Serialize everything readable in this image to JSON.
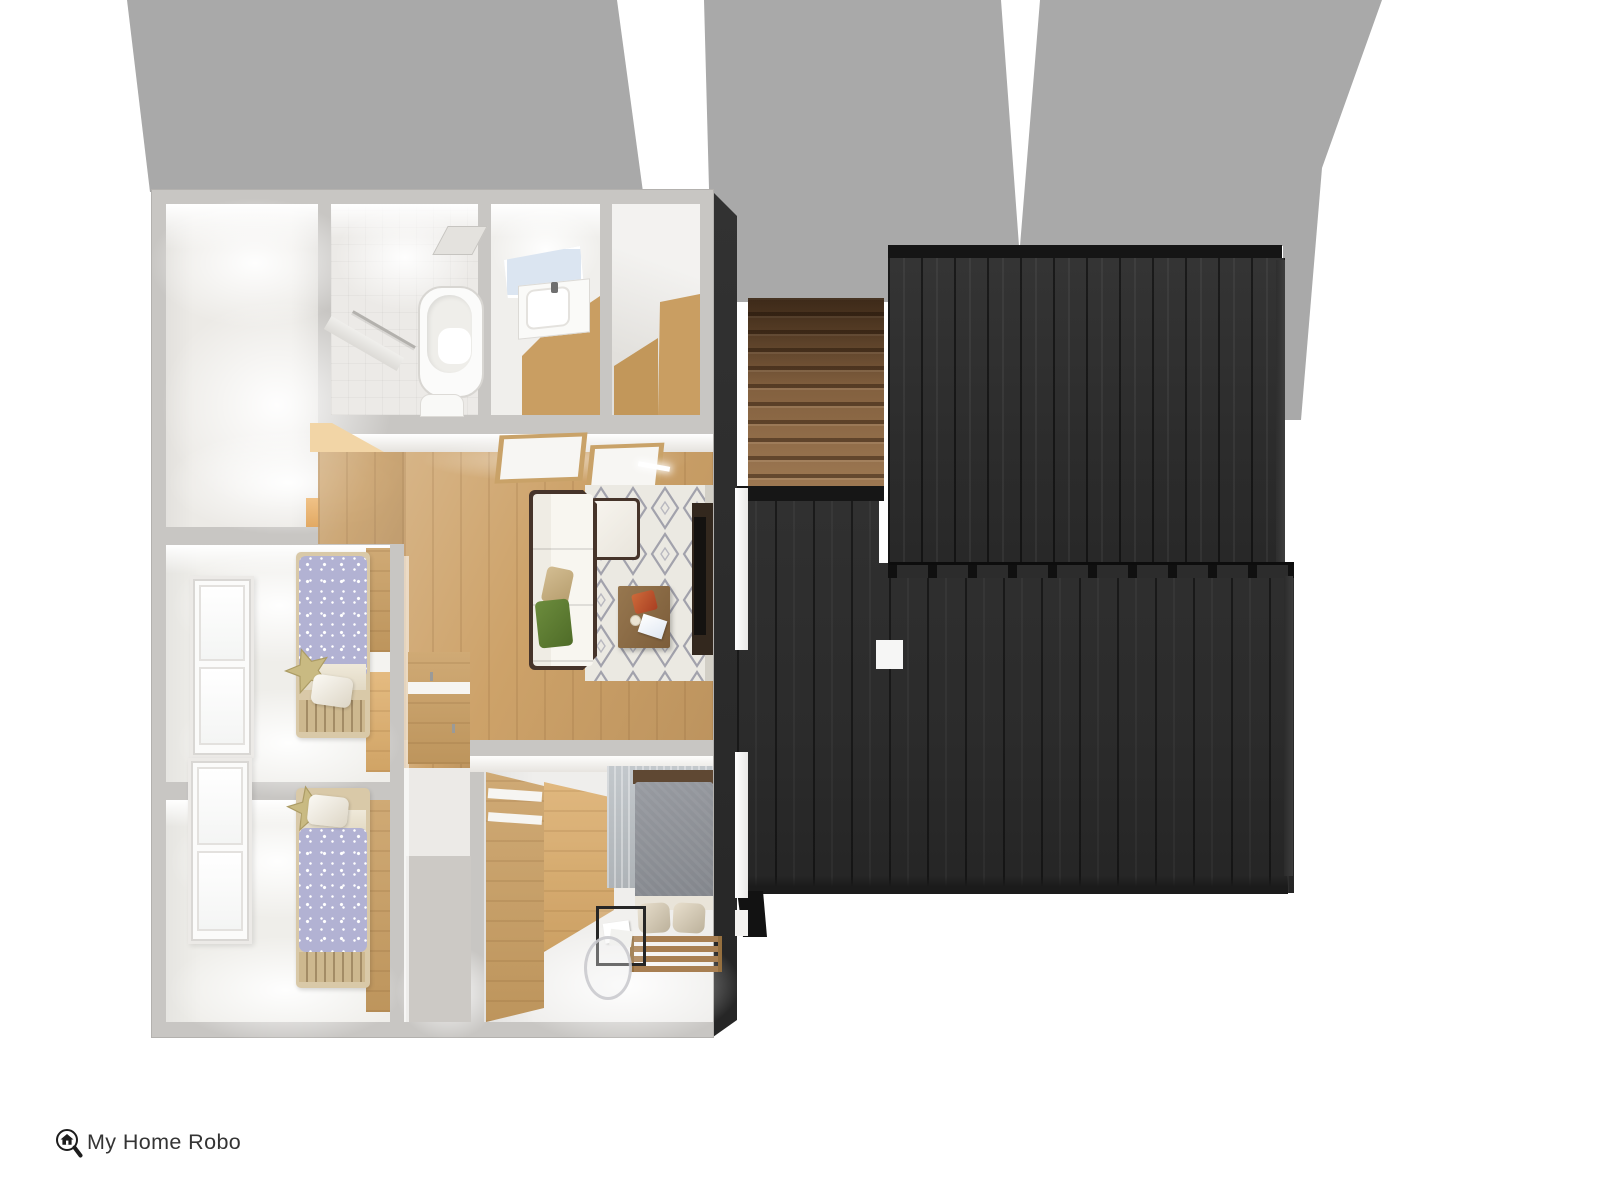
{
  "logo": {
    "text": "My Home Robo",
    "icon": "house-magnifier-icon"
  },
  "scene": {
    "kind": "3d-floorplan-top-view-render"
  },
  "palette": {
    "background": "#ffffff",
    "shadow": "#a9a9a9",
    "wall": "#c8c6c3",
    "room_white": "#efeeeb",
    "wood_floor": "#cda269",
    "wood_panel": "#c99e62",
    "wood_pale": "#f2d5a6",
    "stair_dark": "#6b4b2e",
    "stair_light": "#9d7852",
    "roof": "#2e2e2e",
    "roof_band": "#151515",
    "roof_edge": "#3e3e3e",
    "dark_wall": "#2c2c2c",
    "bed_lavender": "#b2b2d3",
    "star_pillow": "#c9ba82",
    "sofa_white": "#f4f1ea",
    "sofa_trim": "#46342a",
    "rug_base": "#ebe9e2",
    "rug_pattern": "#a2a2ac",
    "pillow_tan": "#c6ad80",
    "pillow_green": "#5e7d33",
    "bed_gray": "#8e9196",
    "rug_gray": "#b9bec2",
    "table_wood": "#8b6b45",
    "tv_dark": "#33281e",
    "mirror_blue": "#dbe5f1",
    "logo_ink": "#343434"
  }
}
